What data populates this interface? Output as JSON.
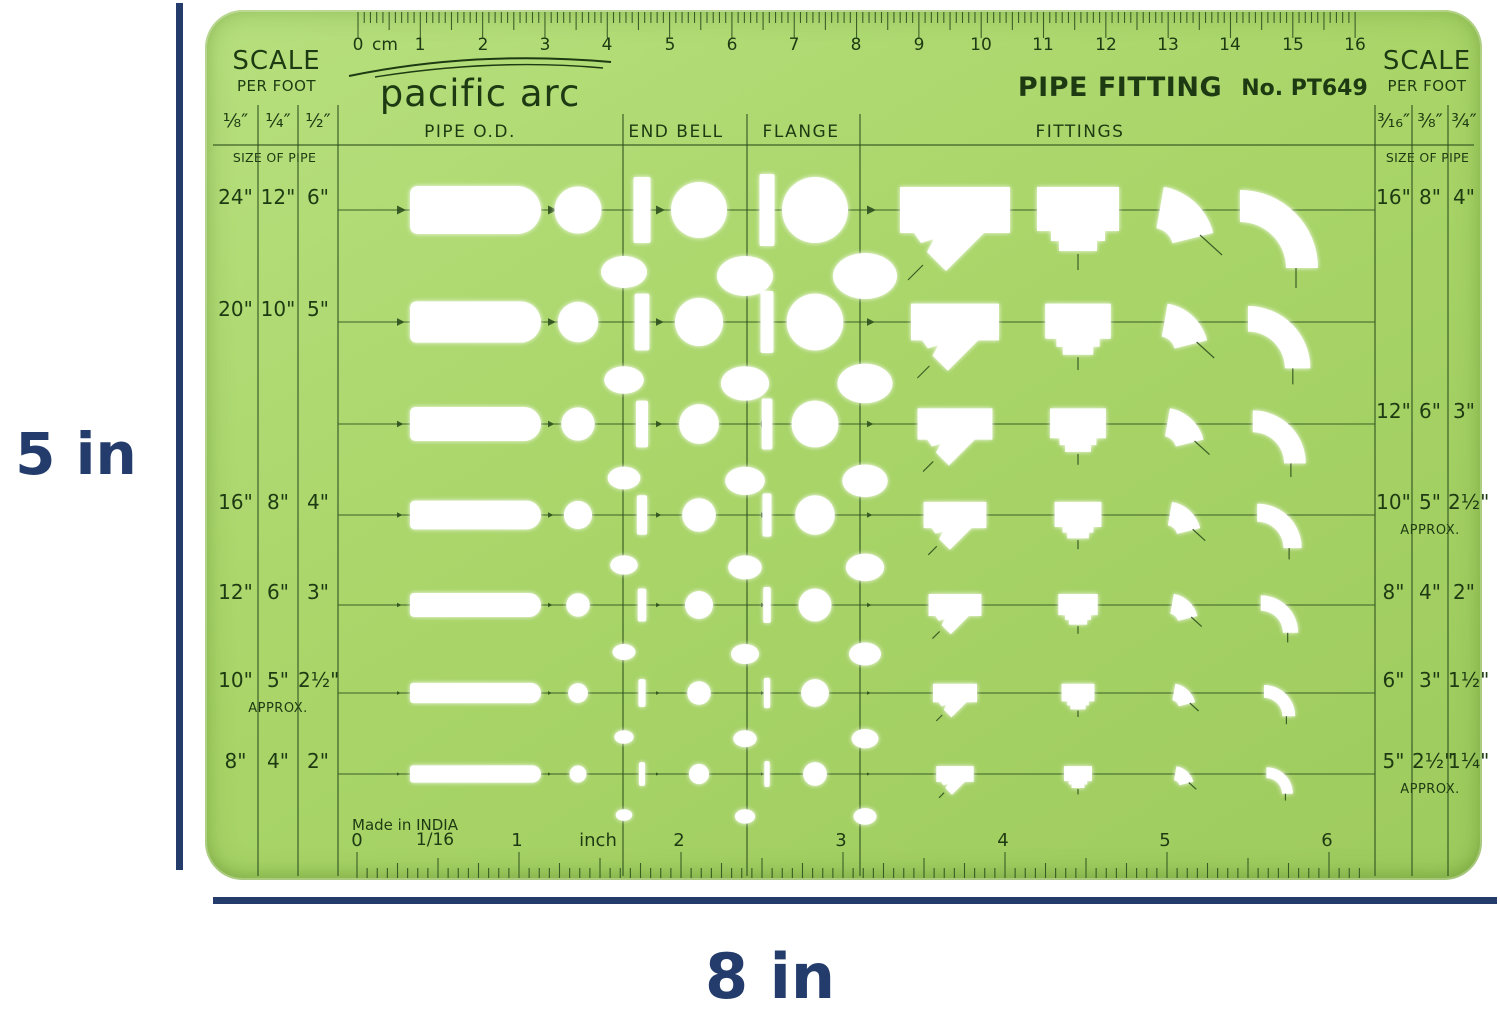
{
  "dimensions": {
    "height_label": "5 in",
    "width_label": "8 in"
  },
  "template": {
    "brand": "pacific arc",
    "title": "PIPE FITTING",
    "model": "No. PT649",
    "made_in": "Made in INDIA",
    "left_scale": {
      "title": "SCALE",
      "subtitle": "PER FOOT",
      "fractions": [
        "¹⁄₈″",
        "¹⁄₄″",
        "¹⁄₂″"
      ],
      "size_of_pipe": "SIZE OF PIPE"
    },
    "right_scale": {
      "title": "SCALE",
      "subtitle": "PER FOOT",
      "fractions": [
        "³⁄₁₆″",
        "³⁄₈″",
        "³⁄₄″"
      ],
      "size_of_pipe": "SIZE OF PIPE"
    },
    "column_headers": [
      "PIPE  O.D.",
      "END  BELL",
      "FLANGE",
      "FITTINGS"
    ],
    "cm_ruler": {
      "unit_label": "cm",
      "start": 0,
      "end": 16
    },
    "inch_ruler": {
      "labels": [
        "0",
        "1/16",
        "1",
        "inch",
        "2",
        "3",
        "4",
        "5",
        "6"
      ]
    },
    "rows": [
      {
        "left": [
          "24\"",
          "12\"",
          "6\""
        ],
        "left_note": "",
        "right": [
          "16\"",
          "8\"",
          "4\""
        ],
        "right_note": ""
      },
      {
        "left": [
          "20\"",
          "10\"",
          "5\""
        ],
        "left_note": "",
        "right": [
          "",
          "",
          ""
        ],
        "right_note": ""
      },
      {
        "left": [
          "",
          "",
          ""
        ],
        "left_note": "",
        "right": [
          "12\"",
          "6\"",
          "3\""
        ],
        "right_note": ""
      },
      {
        "left": [
          "16\"",
          "8\"",
          "4\""
        ],
        "left_note": "",
        "right": [
          "10\"",
          "5\"",
          "2½\""
        ],
        "right_note": "APPROX."
      },
      {
        "left": [
          "12\"",
          "6\"",
          "3\""
        ],
        "left_note": "",
        "right": [
          "8\"",
          "4\"",
          "2\""
        ],
        "right_note": ""
      },
      {
        "left": [
          "10\"",
          "5\"",
          "2½\""
        ],
        "left_note": "APPROX.",
        "right": [
          "6\"",
          "3\"",
          "1½\""
        ],
        "right_note": ""
      },
      {
        "left": [
          "8\"",
          "4\"",
          "2\""
        ],
        "left_note": "",
        "right": [
          "5\"",
          "2½\"",
          "1¼\""
        ],
        "right_note": "APPROX."
      }
    ],
    "row_centers_y": [
      200,
      312,
      414,
      505,
      595,
      683,
      764
    ],
    "pipe_scales": [
      1.0,
      0.86,
      0.71,
      0.6,
      0.5,
      0.42,
      0.36
    ],
    "fitting_scales": [
      1.0,
      0.8,
      0.68,
      0.57,
      0.48,
      0.4,
      0.34
    ],
    "colors": {
      "body_green": "#a9d569",
      "ink": "#1e3a12",
      "line": "#2d4f1e",
      "cutout": "#ffffff",
      "navy": "#233c6b"
    }
  }
}
